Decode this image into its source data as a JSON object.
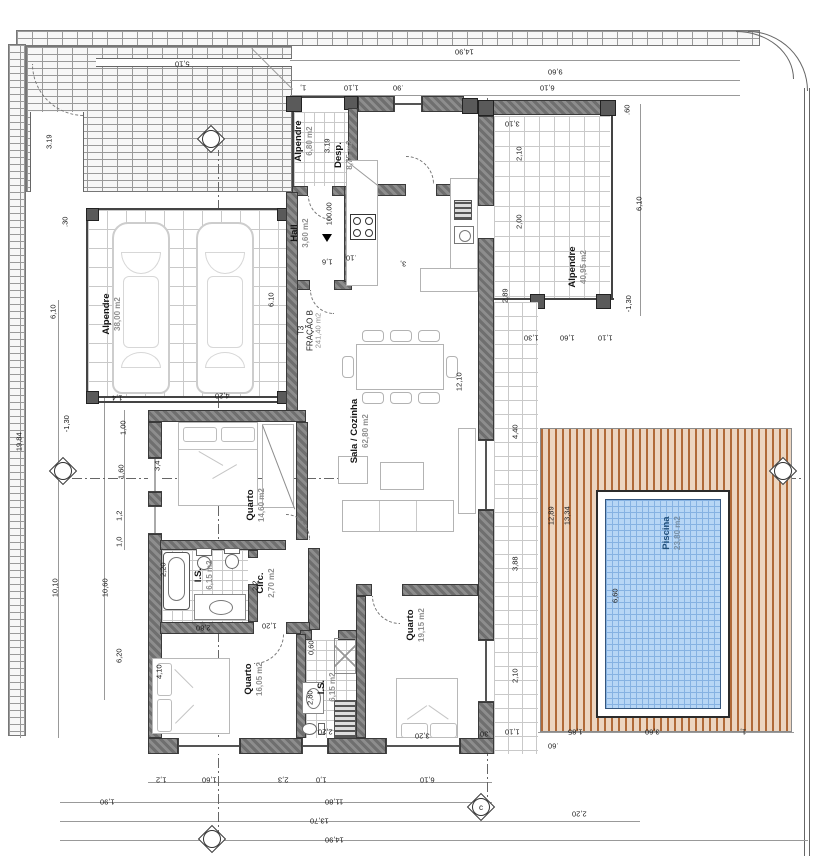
{
  "drawing": {
    "type_label": "T3",
    "fraction_label": "FRAÇÃO B",
    "fraction_area": "241,40 m2",
    "level_mark": "100.00"
  },
  "rooms": [
    {
      "name": "Alpendre",
      "area": "38,00 m2"
    },
    {
      "name": "Alpendre",
      "area": "6,80 m2"
    },
    {
      "name": "Desp.",
      "area": "8,75 m2"
    },
    {
      "name": "Hall",
      "area": "3,60 m2"
    },
    {
      "name": "Sala / Cozinha",
      "area": "62,80 m2"
    },
    {
      "name": "Alpendre",
      "area": "40,95 m2"
    },
    {
      "name": "Quarto",
      "area": "14,60 m2"
    },
    {
      "name": "I.S.",
      "area": "6,15 m2"
    },
    {
      "name": "Circ.",
      "area": "2,70 m2"
    },
    {
      "name": "Quarto",
      "area": "16,05 m2"
    },
    {
      "name": "I.S.",
      "area": "6,15 m2"
    },
    {
      "name": "Quarto",
      "area": "19,15 m2"
    },
    {
      "name": "Piscina",
      "area": "23,80 m2"
    }
  ],
  "dimensions": [
    {
      "t": "14,90",
      "x": 455,
      "y": 48,
      "r": 180
    },
    {
      "t": "9,60",
      "x": 548,
      "y": 68,
      "r": 180
    },
    {
      "t": "1,",
      "x": 300,
      "y": 84,
      "r": 180
    },
    {
      "t": "1,10",
      "x": 344,
      "y": 84,
      "r": 180
    },
    {
      "t": ".90",
      "x": 393,
      "y": 84,
      "r": 180
    },
    {
      "t": "6,10",
      "x": 540,
      "y": 84,
      "r": 180
    },
    {
      "t": "5,10",
      "x": 175,
      "y": 60,
      "r": 180
    },
    {
      "t": ".60",
      "x": 622,
      "y": 106,
      "r": 90
    },
    {
      "t": "3,10",
      "x": 505,
      "y": 120,
      "r": 180
    },
    {
      "t": "2,10",
      "x": 512,
      "y": 150,
      "r": 90
    },
    {
      "t": "2,00",
      "x": 512,
      "y": 218,
      "r": 90
    },
    {
      "t": "2,89",
      "x": 498,
      "y": 292,
      "r": 90
    },
    {
      "t": "6,10",
      "x": 632,
      "y": 200,
      "r": 90
    },
    {
      "t": "-1,30",
      "x": 620,
      "y": 300,
      "r": 90
    },
    {
      "t": "1,30",
      "x": 524,
      "y": 334,
      "r": 180
    },
    {
      "t": "1,60",
      "x": 560,
      "y": 334,
      "r": 180
    },
    {
      "t": "1,10",
      "x": 598,
      "y": 334,
      "r": 180
    },
    {
      "t": "3.19",
      "x": 42,
      "y": 138,
      "r": 90
    },
    {
      "t": "6,10",
      "x": 46,
      "y": 308,
      "r": 90
    },
    {
      "t": ".30",
      "x": 60,
      "y": 218,
      "r": 90
    },
    {
      "t": "-1,30",
      "x": 58,
      "y": 420,
      "r": 90
    },
    {
      "t": "19,84",
      "x": 10,
      "y": 438,
      "r": 90
    },
    {
      "t": "1,00",
      "x": 116,
      "y": 424,
      "r": 90
    },
    {
      "t": "1,60",
      "x": 114,
      "y": 468,
      "r": 90
    },
    {
      "t": "1,2",
      "x": 114,
      "y": 512,
      "r": 90
    },
    {
      "t": "1,0",
      "x": 114,
      "y": 538,
      "r": 90
    },
    {
      "t": "3,4",
      "x": 152,
      "y": 462,
      "r": 90
    },
    {
      "t": "10,10",
      "x": 46,
      "y": 584,
      "r": 90
    },
    {
      "t": "10,60",
      "x": 96,
      "y": 584,
      "r": 90
    },
    {
      "t": "6,20",
      "x": 112,
      "y": 652,
      "r": 90
    },
    {
      "t": "4,10",
      "x": 152,
      "y": 668,
      "r": 90
    },
    {
      "t": "2,20",
      "x": 156,
      "y": 566,
      "r": 90
    },
    {
      "t": "1,4",
      "x": 112,
      "y": 394,
      "r": 180
    },
    {
      "t": "4,20",
      "x": 215,
      "y": 392,
      "r": 180
    },
    {
      "t": "6.10",
      "x": 264,
      "y": 296,
      "r": 90
    },
    {
      "t": "3.19",
      "x": 320,
      "y": 142,
      "r": 90
    },
    {
      "t": "1,2",
      "x": 156,
      "y": 776,
      "r": 180
    },
    {
      "t": "1,60",
      "x": 202,
      "y": 776,
      "r": 180
    },
    {
      "t": "2,3",
      "x": 278,
      "y": 776,
      "r": 180
    },
    {
      "t": "1,0",
      "x": 316,
      "y": 776,
      "r": 180
    },
    {
      "t": "6,10",
      "x": 420,
      "y": 776,
      "r": 180
    },
    {
      "t": "1,90",
      "x": 100,
      "y": 798,
      "r": 180
    },
    {
      "t": "11,80",
      "x": 325,
      "y": 798,
      "r": 180
    },
    {
      "t": "13,70",
      "x": 310,
      "y": 817,
      "r": 180
    },
    {
      "t": "14,90",
      "x": 325,
      "y": 836,
      "r": 180
    },
    {
      "t": "12,10",
      "x": 450,
      "y": 378,
      "r": 90
    },
    {
      "t": "1,6",
      "x": 322,
      "y": 258,
      "r": 180
    },
    {
      "t": ".10",
      "x": 346,
      "y": 254,
      "r": 180
    },
    {
      "t": "3,",
      "x": 400,
      "y": 260,
      "r": 180
    },
    {
      "t": "2,80",
      "x": 196,
      "y": 624,
      "r": 180
    },
    {
      "t": "1,20",
      "x": 262,
      "y": 622,
      "r": 180
    },
    {
      "t": "0,60",
      "x": 304,
      "y": 644,
      "r": 90
    },
    {
      "t": "2,2",
      "x": 250,
      "y": 582,
      "r": 90
    },
    {
      "t": "3,20",
      "x": 415,
      "y": 732,
      "r": 180
    },
    {
      "t": "2,20",
      "x": 318,
      "y": 728,
      "r": 180
    },
    {
      "t": "2,80",
      "x": 303,
      "y": 694,
      "r": 90
    },
    {
      "t": "4,40",
      "x": 508,
      "y": 428,
      "r": 90
    },
    {
      "t": "3,88",
      "x": 508,
      "y": 560,
      "r": 90
    },
    {
      "t": "2,10",
      "x": 508,
      "y": 672,
      "r": 90
    },
    {
      "t": "12,89",
      "x": 542,
      "y": 512,
      "r": 90
    },
    {
      "t": "13,34",
      "x": 558,
      "y": 512,
      "r": 90
    },
    {
      "t": "6,60",
      "x": 608,
      "y": 592,
      "r": 90
    },
    {
      "t": "1,10",
      "x": 505,
      "y": 728,
      "r": 180
    },
    {
      "t": ".30",
      "x": 480,
      "y": 730,
      "r": 180
    },
    {
      "t": ".60",
      "x": 548,
      "y": 742,
      "r": 180
    },
    {
      "t": "1,85",
      "x": 568,
      "y": 728,
      "r": 180
    },
    {
      "t": "3,60",
      "x": 645,
      "y": 728,
      "r": 180
    },
    {
      "t": "1,",
      "x": 740,
      "y": 728,
      "r": 180
    },
    {
      "t": "2,20",
      "x": 572,
      "y": 810,
      "r": 180
    }
  ],
  "markers": [
    {
      "letter": "",
      "x": 196,
      "y": 124
    },
    {
      "letter": "",
      "x": 48,
      "y": 456
    },
    {
      "letter": "",
      "x": 768,
      "y": 456
    },
    {
      "letter": "",
      "x": 197,
      "y": 824
    },
    {
      "letter": "c",
      "x": 466,
      "y": 792
    }
  ],
  "colors": {
    "wall": "#6f6f6f",
    "pool_water": "#b7d6f5",
    "pool_grid": "#86b2e2",
    "deck_light": "#ecd5c0",
    "deck_dark": "#b06a38",
    "brick_line": "#9a9a9a",
    "dim_text": "#1a1a1a",
    "area_text": "#8f8f8f"
  }
}
